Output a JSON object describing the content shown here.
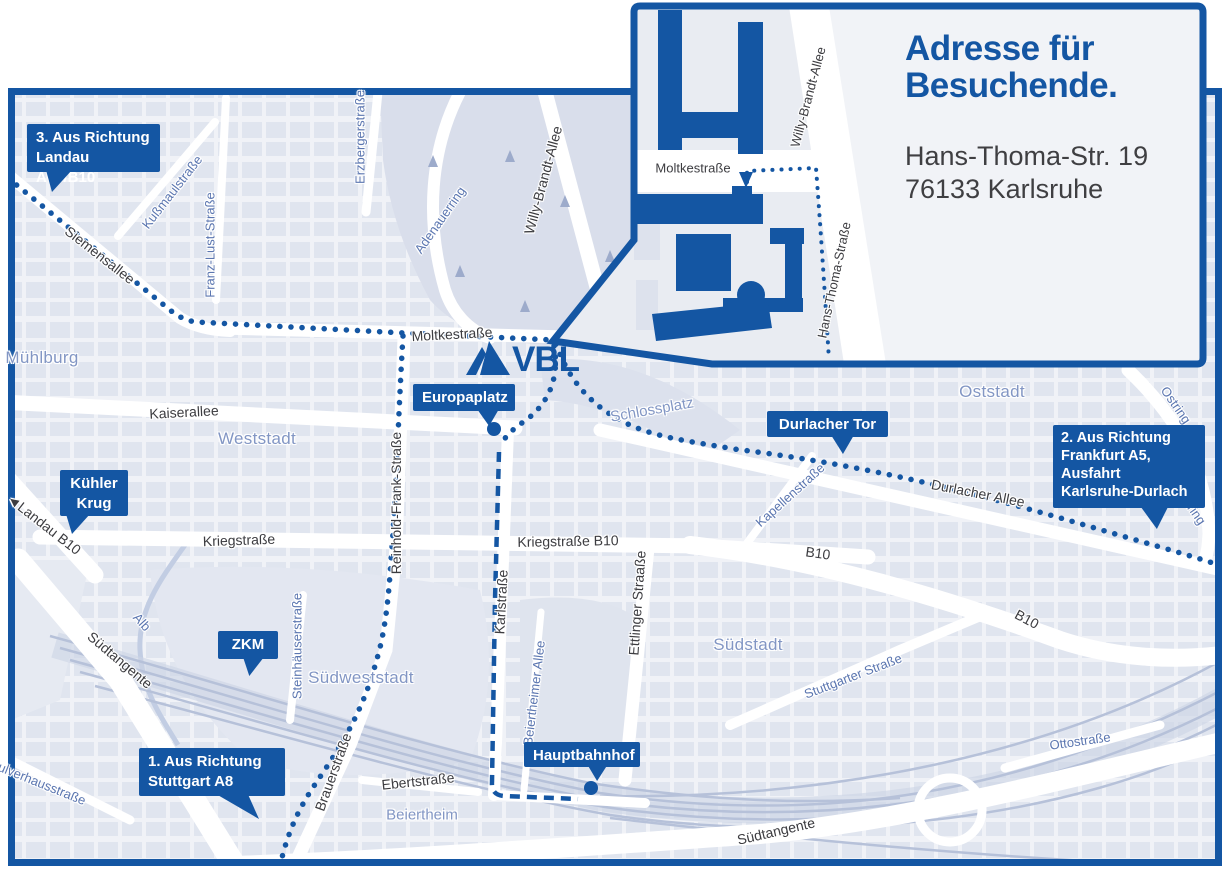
{
  "colors": {
    "brand_blue": "#1456a3",
    "map_background": "#f0f2f7",
    "city_block": "#dee3ee",
    "park": "#dbe0ec",
    "road_white": "#ffffff",
    "rail": "#b6c1d9",
    "dark_street_label": "#3c3c40",
    "blue_street_label": "#5b76b0",
    "area_label": "#8296c4"
  },
  "logo": {
    "text": "VBL",
    "icon": "vbl-pyramid-icon"
  },
  "inset": {
    "title_line1": "Adresse für",
    "title_line2": "Besuchende.",
    "address_line1": "Hans-Thoma-Str. 19",
    "address_line2": "76133 Karlsruhe"
  },
  "callouts": [
    {
      "id": "route-3-landau",
      "lines": [
        "3. Aus Richtung",
        "Landau A65/B10"
      ],
      "x": 27,
      "y": 124,
      "w": 133,
      "h": 48,
      "align": "left",
      "tail": {
        "x": 46,
        "y": 170,
        "w": 26,
        "h": 22,
        "poly": "0% 0%,100% 0%,23% 100%"
      }
    },
    {
      "id": "kuehler-krug",
      "lines": [
        "Kühler",
        "Krug"
      ],
      "x": 60,
      "y": 470,
      "w": 68,
      "h": 46,
      "align": "center",
      "tail": {
        "x": 66,
        "y": 514,
        "w": 24,
        "h": 20,
        "poly": "0% 0%,100% 0%,25% 100%"
      }
    },
    {
      "id": "zkm",
      "lines": [
        "ZKM"
      ],
      "x": 218,
      "y": 631,
      "w": 60,
      "h": 28,
      "align": "center",
      "tail": {
        "x": 243,
        "y": 657,
        "w": 21,
        "h": 19,
        "poly": "0% 0%,100% 0%,30% 100%"
      }
    },
    {
      "id": "route-1-stuttgart",
      "lines": [
        "1. Aus Richtung",
        "Stuttgart A8"
      ],
      "x": 139,
      "y": 748,
      "w": 146,
      "h": 48,
      "align": "left",
      "tail": {
        "x": 216,
        "y": 794,
        "w": 43,
        "h": 25,
        "poly": "0% 0%,74% 0%,100% 100%"
      }
    },
    {
      "id": "europaplatz",
      "lines": [
        "Europaplatz"
      ],
      "x": 413,
      "y": 384,
      "w": 102,
      "h": 27,
      "align": "center",
      "tail": {
        "x": 477,
        "y": 409,
        "w": 22,
        "h": 17,
        "poly": "0% 0%,100% 0%,55% 100%"
      }
    },
    {
      "id": "durlacher-tor",
      "lines": [
        "Durlacher Tor"
      ],
      "x": 767,
      "y": 411,
      "w": 121,
      "h": 26,
      "align": "center",
      "tail": {
        "x": 831,
        "y": 435,
        "w": 23,
        "h": 19,
        "poly": "0% 0%,100% 0%,52% 100%"
      }
    },
    {
      "id": "route-2-frankfurt",
      "lines": [
        "2. Aus Richtung",
        "Frankfurt A5,",
        "Ausfahrt",
        "Karlsruhe-Durlach"
      ],
      "x": 1053,
      "y": 425,
      "w": 152,
      "h": 83,
      "align": "left",
      "tail": {
        "x": 1138,
        "y": 503,
        "w": 32,
        "h": 26,
        "poly": "0% 0%,100% 0%,59% 100%"
      }
    },
    {
      "id": "hauptbahnhof",
      "lines": [
        "Hauptbahnhof"
      ],
      "x": 524,
      "y": 742,
      "w": 116,
      "h": 25,
      "align": "center",
      "tail": {
        "x": 587,
        "y": 764,
        "w": 21,
        "h": 17,
        "poly": "0% 0%,100% 0%,48% 100%"
      }
    }
  ],
  "street_labels": [
    {
      "text": "Siemensallee",
      "x": 100,
      "y": 255,
      "rot": 38,
      "cls": "dark"
    },
    {
      "text": "Moltkestraße",
      "x": 452,
      "y": 334,
      "rot": -3,
      "cls": "dark"
    },
    {
      "text": "Kaiserallee",
      "x": 184,
      "y": 412,
      "rot": -3,
      "cls": "dark"
    },
    {
      "text": "Kriegstraße",
      "x": 239,
      "y": 540,
      "rot": -2,
      "cls": "dark"
    },
    {
      "text": "Kriegstraße B10",
      "x": 568,
      "y": 541,
      "rot": -1,
      "cls": "dark"
    },
    {
      "text": "Reinhold-Frank-Straße",
      "x": 396,
      "y": 503,
      "rot": -90,
      "cls": "dark"
    },
    {
      "text": "Karlstraße",
      "x": 501,
      "y": 602,
      "rot": -87,
      "cls": "dark"
    },
    {
      "text": "Ettlinger Straaße",
      "x": 637,
      "y": 603,
      "rot": -86,
      "cls": "dark"
    },
    {
      "text": "Durlacher Allee",
      "x": 978,
      "y": 493,
      "rot": 11,
      "cls": "dark"
    },
    {
      "text": "B10",
      "x": 818,
      "y": 553,
      "rot": 8,
      "cls": "dark"
    },
    {
      "text": "B10",
      "x": 1027,
      "y": 619,
      "rot": 28,
      "cls": "dark"
    },
    {
      "text": "Südtangente",
      "x": 120,
      "y": 660,
      "rot": 40,
      "cls": "dark"
    },
    {
      "text": "Südtangente",
      "x": 776,
      "y": 831,
      "rot": -13,
      "cls": "dark"
    },
    {
      "text": "◄Landau B10",
      "x": 44,
      "y": 524,
      "rot": 38,
      "cls": "dark"
    },
    {
      "text": "Brauerstraße",
      "x": 333,
      "y": 772,
      "rot": -70,
      "cls": "dark"
    },
    {
      "text": "Ebertstraße",
      "x": 418,
      "y": 781,
      "rot": -6,
      "cls": "dark"
    },
    {
      "text": "Willy-Brandt-Allee",
      "x": 543,
      "y": 180,
      "rot": -75,
      "cls": "dark"
    },
    {
      "text": "Kußmaulstraße",
      "x": 172,
      "y": 192,
      "rot": -52,
      "cls": "blue"
    },
    {
      "text": "Franz-Lust-Straße",
      "x": 210,
      "y": 245,
      "rot": -90,
      "cls": "blue"
    },
    {
      "text": "Erzbergerstraße",
      "x": 360,
      "y": 137,
      "rot": -90,
      "cls": "blue"
    },
    {
      "text": "Adenauerring",
      "x": 440,
      "y": 220,
      "rot": -55,
      "cls": "blue"
    },
    {
      "text": "Kapellenstraße",
      "x": 790,
      "y": 495,
      "rot": -42,
      "cls": "blue"
    },
    {
      "text": "Ostring",
      "x": 1176,
      "y": 405,
      "rot": 55,
      "cls": "blue"
    },
    {
      "text": "Ostring",
      "x": 1191,
      "y": 506,
      "rot": 55,
      "cls": "blue"
    },
    {
      "text": "Steinhäuserstraße",
      "x": 297,
      "y": 646,
      "rot": -90,
      "cls": "blue"
    },
    {
      "text": "Stuttgarter Straße",
      "x": 853,
      "y": 676,
      "rot": -21,
      "cls": "blue"
    },
    {
      "text": "Ottostraße",
      "x": 1080,
      "y": 741,
      "rot": -8,
      "cls": "blue"
    },
    {
      "text": "Alb",
      "x": 142,
      "y": 622,
      "rot": 48,
      "cls": "blue"
    },
    {
      "text": "Beiertheimer Allee",
      "x": 534,
      "y": 693,
      "rot": -83,
      "cls": "blue"
    },
    {
      "text": "Pulverhausstraße",
      "x": 38,
      "y": 782,
      "rot": 22,
      "cls": "blue"
    },
    {
      "text": "Moltkestraße",
      "x": 693,
      "y": 168,
      "rot": 0,
      "cls": "inset-lbl"
    },
    {
      "text": "Willy-Brandt-Allee",
      "x": 808,
      "y": 97,
      "rot": -75,
      "cls": "inset-lbl"
    },
    {
      "text": "Hans-Thoma-Straße",
      "x": 834,
      "y": 280,
      "rot": -78,
      "cls": "inset-lbl"
    }
  ],
  "area_labels": [
    {
      "text": "Mühlburg",
      "x": 42,
      "y": 358,
      "rot": 0,
      "cls": "area"
    },
    {
      "text": "Weststadt",
      "x": 257,
      "y": 439,
      "rot": 0,
      "cls": "area"
    },
    {
      "text": "Südweststadt",
      "x": 361,
      "y": 678,
      "rot": 0,
      "cls": "area"
    },
    {
      "text": "Südstadt",
      "x": 748,
      "y": 645,
      "rot": 0,
      "cls": "area"
    },
    {
      "text": "Oststadt",
      "x": 992,
      "y": 392,
      "rot": 0,
      "cls": "area"
    },
    {
      "text": "Beiertheim",
      "x": 422,
      "y": 815,
      "rot": 0,
      "cls": "area-sm"
    },
    {
      "text": "Schlossplatz",
      "x": 652,
      "y": 410,
      "rot": -10,
      "cls": "area-sm"
    }
  ]
}
